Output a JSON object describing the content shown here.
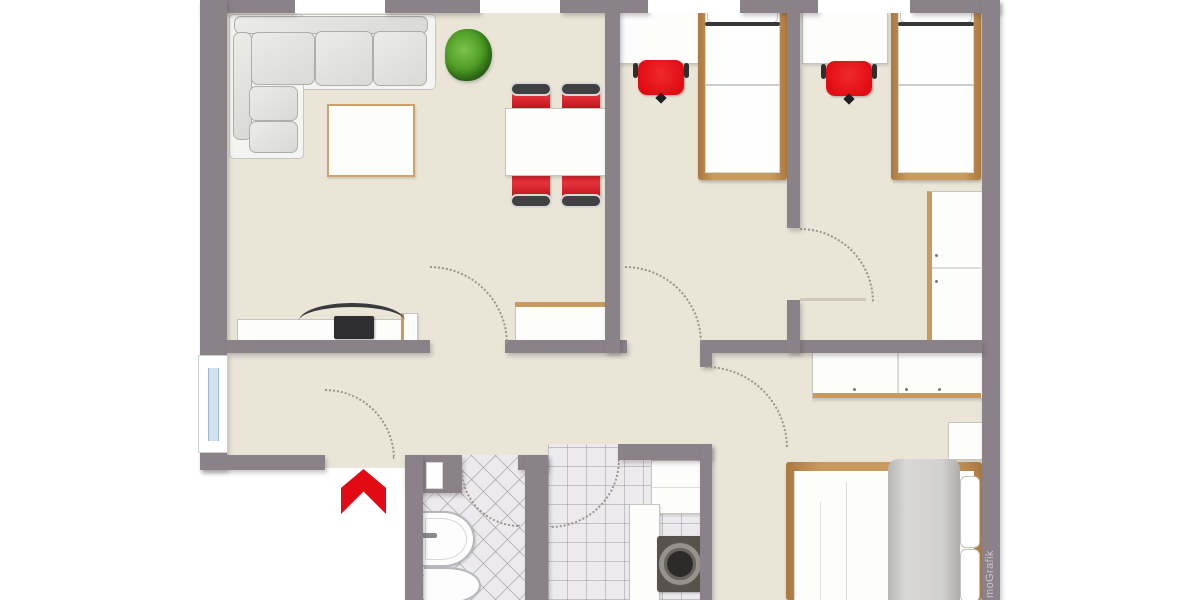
{
  "watermark": {
    "text": "moGrafik"
  },
  "colors": {
    "wall": "#8b8188",
    "floor": "#eae5d7",
    "tile": "#eceaec",
    "wood": "#c99a5d",
    "red": "#e30b13",
    "glass": "#cfe2ee",
    "cushion": "#d9d9d6",
    "watermark": "#cbc4c6"
  },
  "plan": {
    "type": "apartment-floor-plan",
    "rooms": [
      {
        "name": "living-room",
        "furniture": [
          "corner-sofa",
          "coffee-table",
          "plant",
          "dining-table",
          "dining-chairs",
          "tv-sideboard",
          "sideboard"
        ]
      },
      {
        "name": "bedroom-1",
        "furniture": [
          "desk",
          "desk-chair",
          "single-bed"
        ]
      },
      {
        "name": "bedroom-2",
        "furniture": [
          "desk",
          "desk-chair",
          "single-bed",
          "wardrobe"
        ]
      },
      {
        "name": "hallway",
        "furniture": [
          "window",
          "entrance-arrow"
        ]
      },
      {
        "name": "bathroom",
        "furniture": [
          "wash-basin",
          "toilet",
          "duct-niche"
        ]
      },
      {
        "name": "utility-room",
        "furniture": [
          "counter",
          "tall-cabinet",
          "washing-machine"
        ]
      },
      {
        "name": "master-bedroom",
        "furniture": [
          "wardrobe-row",
          "nightstand",
          "double-bed"
        ]
      }
    ]
  }
}
